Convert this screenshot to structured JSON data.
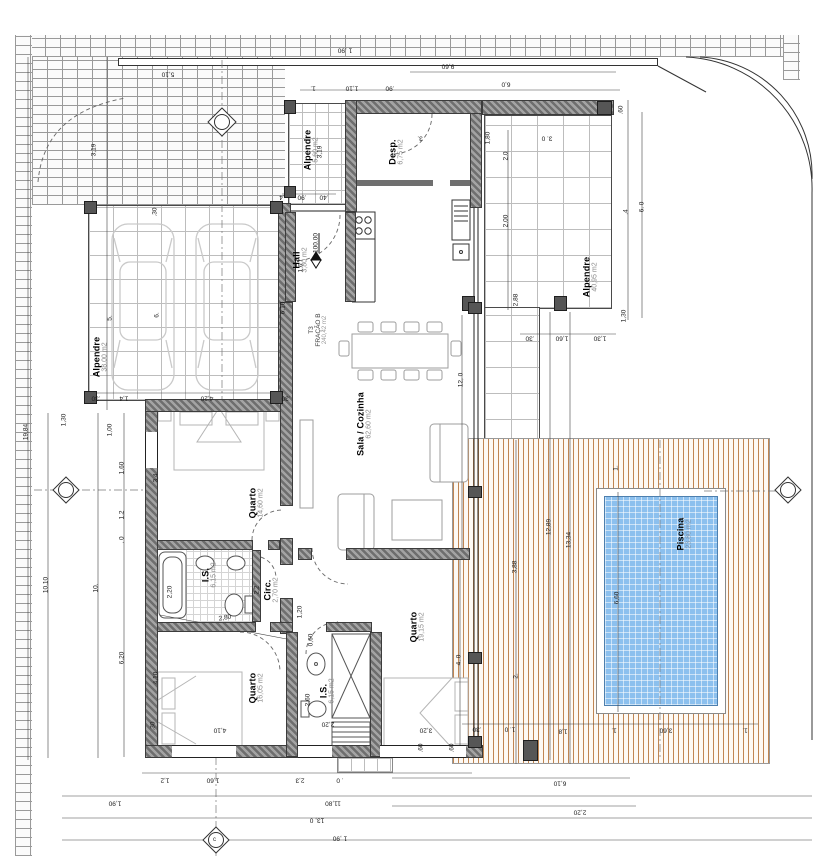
{
  "meta": {
    "drawing_type": "floor-plan",
    "fraction": {
      "line1": "T3",
      "line2": "FRAÇÃO B",
      "area": "240,42 m2"
    },
    "level_mark": "100.00",
    "axis_letter": "c"
  },
  "colors": {
    "wall1": "#a3a3a3",
    "wall2": "#6e6e6e",
    "brickline": "#9a9a9a",
    "tileline": "#bdbdbd",
    "deck1": "#c08552",
    "deck2": "#8a5a33",
    "pool": "#8cc0ee"
  },
  "rooms": [
    {
      "name": "Alpendre",
      "area": "38,00 m2"
    },
    {
      "name": "Alpendre",
      "area": "5,60 m2"
    },
    {
      "name": "Desp.",
      "area": "6,75 m2"
    },
    {
      "name": "Hall",
      "area": "3,80 m2"
    },
    {
      "name": "Sala / Cozinha",
      "area": "62,60 m2"
    },
    {
      "name": "Quarto",
      "area": "14,60 m2"
    },
    {
      "name": "I.S.",
      "area": "6,15 m2"
    },
    {
      "name": "Circ.",
      "area": "2,70 m2"
    },
    {
      "name": "Quarto",
      "area": "16,05 m2"
    },
    {
      "name": "I.S.",
      "area": "6,15 m2"
    },
    {
      "name": "Quarto",
      "area": "19,15 m2"
    },
    {
      "name": "Alpendre",
      "area": "40,95 m2"
    },
    {
      "name": "Piscina",
      "area": "23,80 m2"
    }
  ],
  "dimensions": [
    {
      "t": "19,84",
      "x": 26,
      "y": 432,
      "r": -90
    },
    {
      "t": "10,10",
      "x": 46,
      "y": 585,
      "r": -90
    },
    {
      "t": "10.",
      "x": 96,
      "y": 588,
      "r": -90
    },
    {
      "t": "3,19",
      "x": 94,
      "y": 150,
      "r": -90
    },
    {
      "t": "5.",
      "x": 110,
      "y": 318,
      "r": -90
    },
    {
      "t": "1,30",
      "x": 64,
      "y": 420,
      "r": -90
    },
    {
      "t": ".30",
      "x": 155,
      "y": 212,
      "r": -90
    },
    {
      "t": "6.",
      "x": 157,
      "y": 315,
      "r": -90
    },
    {
      "t": "1,00",
      "x": 110,
      "y": 430,
      "r": -90
    },
    {
      "t": "1,60",
      "x": 122,
      "y": 468,
      "r": -90
    },
    {
      "t": "1,2",
      "x": 122,
      "y": 515,
      "r": -90
    },
    {
      "t": ". 0",
      "x": 122,
      "y": 540,
      "r": -90
    },
    {
      "t": "6,20",
      "x": 122,
      "y": 658,
      "r": -90
    },
    {
      "t": "3,4",
      "x": 156,
      "y": 478,
      "r": -90
    },
    {
      "t": "4,10",
      "x": 156,
      "y": 678,
      "r": -90
    },
    {
      "t": "2,20",
      "x": 170,
      "y": 592,
      "r": -90
    },
    {
      "t": "3,19",
      "x": 320,
      "y": 152,
      "r": -90
    },
    {
      "t": "1 ,90",
      "x": 345,
      "y": 50,
      "r": 180
    },
    {
      "t": "5,10",
      "x": 168,
      "y": 74,
      "r": 180
    },
    {
      "t": "1.",
      "x": 313,
      "y": 88,
      "r": 180
    },
    {
      "t": "1,10",
      "x": 352,
      "y": 88,
      "r": 180
    },
    {
      "t": ".90",
      "x": 390,
      "y": 88,
      "r": 180
    },
    {
      "t": "9,60",
      "x": 448,
      "y": 66,
      "r": 180
    },
    {
      "t": "6,0",
      "x": 506,
      "y": 84,
      "r": 180
    },
    {
      "t": ".4",
      "x": 282,
      "y": 197,
      "r": 180
    },
    {
      "t": ".90",
      "x": 302,
      "y": 197,
      "r": 180
    },
    {
      "t": ".40",
      "x": 324,
      "y": 197,
      "r": 180
    },
    {
      "t": "3. 0",
      "x": 547,
      "y": 138,
      "r": 180
    },
    {
      "t": "3.",
      "x": 420,
      "y": 138,
      "r": 180
    },
    {
      "t": ".30",
      "x": 530,
      "y": 338,
      "r": 180
    },
    {
      "t": "1,60",
      "x": 562,
      "y": 338,
      "r": 180
    },
    {
      "t": "1,30",
      "x": 600,
      "y": 338,
      "r": 180
    },
    {
      "t": ".30",
      "x": 96,
      "y": 398,
      "r": 180
    },
    {
      "t": "1,4",
      "x": 124,
      "y": 398,
      "r": 180
    },
    {
      "t": "4,20",
      "x": 207,
      "y": 398,
      "r": 180
    },
    {
      "t": ".30",
      "x": 286,
      "y": 398,
      "r": 180
    },
    {
      "t": ".60",
      "x": 621,
      "y": 110,
      "r": -90
    },
    {
      "t": ".4",
      "x": 626,
      "y": 212,
      "r": -90
    },
    {
      "t": "6. 0",
      "x": 642,
      "y": 207,
      "r": -90
    },
    {
      "t": "1,30",
      "x": 624,
      "y": 316,
      "r": -90
    },
    {
      "t": "2,0",
      "x": 506,
      "y": 156,
      "r": -90
    },
    {
      "t": "2,00",
      "x": 506,
      "y": 221,
      "r": -90
    },
    {
      "t": "2,88",
      "x": 516,
      "y": 300,
      "r": -90
    },
    {
      "t": "1,80",
      "x": 488,
      "y": 138,
      "r": -90
    },
    {
      "t": "12, 0",
      "x": 461,
      "y": 380,
      "r": -90
    },
    {
      "t": "12,89",
      "x": 549,
      "y": 527,
      "r": -90
    },
    {
      "t": "13,34",
      "x": 569,
      "y": 540,
      "r": -90
    },
    {
      "t": "3,88",
      "x": 515,
      "y": 567,
      "r": -90
    },
    {
      "t": "6,60",
      "x": 617,
      "y": 598,
      "r": -90
    },
    {
      "t": "2.",
      "x": 516,
      "y": 676,
      "r": -90
    },
    {
      "t": "4. 0",
      "x": 459,
      "y": 660,
      "r": -90
    },
    {
      "t": "1.",
      "x": 616,
      "y": 468,
      "r": -90
    },
    {
      "t": "6,10",
      "x": 283,
      "y": 308,
      "r": -90
    },
    {
      "t": "1,6",
      "x": 301,
      "y": 268,
      "r": -90
    },
    {
      "t": "2,2",
      "x": 257,
      "y": 590,
      "r": -90
    },
    {
      "t": "1,20",
      "x": 300,
      "y": 612,
      "r": -90
    },
    {
      "t": "0,60",
      "x": 311,
      "y": 640,
      "r": -90
    },
    {
      "t": "2,60",
      "x": 308,
      "y": 700,
      "r": -90
    },
    {
      "t": ".30",
      "x": 153,
      "y": 726,
      "r": -90
    },
    {
      "t": ".60",
      "x": 421,
      "y": 748,
      "r": -90
    },
    {
      "t": ".60",
      "x": 452,
      "y": 748,
      "r": -90
    },
    {
      "t": ".30",
      "x": 477,
      "y": 729,
      "r": 180
    },
    {
      "t": "1. 0",
      "x": 510,
      "y": 729,
      "r": 180
    },
    {
      "t": "1,8",
      "x": 563,
      "y": 731,
      "r": 180
    },
    {
      "t": "1.",
      "x": 614,
      "y": 730,
      "r": 180
    },
    {
      "t": "3,60",
      "x": 666,
      "y": 730,
      "r": 180
    },
    {
      "t": "1.",
      "x": 745,
      "y": 730,
      "r": 180
    },
    {
      "t": "2,20",
      "x": 328,
      "y": 724,
      "r": 180
    },
    {
      "t": "3,20",
      "x": 426,
      "y": 730,
      "r": 180
    },
    {
      "t": "4,10",
      "x": 220,
      "y": 730,
      "r": 180
    },
    {
      "t": "2,80",
      "x": 225,
      "y": 618,
      "r": -10
    },
    {
      "t": "1,2",
      "x": 165,
      "y": 780,
      "r": 180
    },
    {
      "t": "1,60",
      "x": 213,
      "y": 780,
      "r": 180
    },
    {
      "t": "2,3",
      "x": 300,
      "y": 780,
      "r": 180
    },
    {
      "t": ". 0",
      "x": 340,
      "y": 780,
      "r": 180
    },
    {
      "t": "6,10",
      "x": 560,
      "y": 783,
      "r": 180
    },
    {
      "t": "1,90",
      "x": 115,
      "y": 803,
      "r": 180
    },
    {
      "t": "11,80",
      "x": 333,
      "y": 803,
      "r": 180
    },
    {
      "t": "13, 0",
      "x": 317,
      "y": 820,
      "r": 180
    },
    {
      "t": "1 ,90",
      "x": 340,
      "y": 838,
      "r": 180
    },
    {
      "t": "2,20",
      "x": 580,
      "y": 812,
      "r": 180
    },
    {
      "t": "100.00",
      "x": 316,
      "y": 243,
      "r": -90,
      "u": true
    }
  ]
}
